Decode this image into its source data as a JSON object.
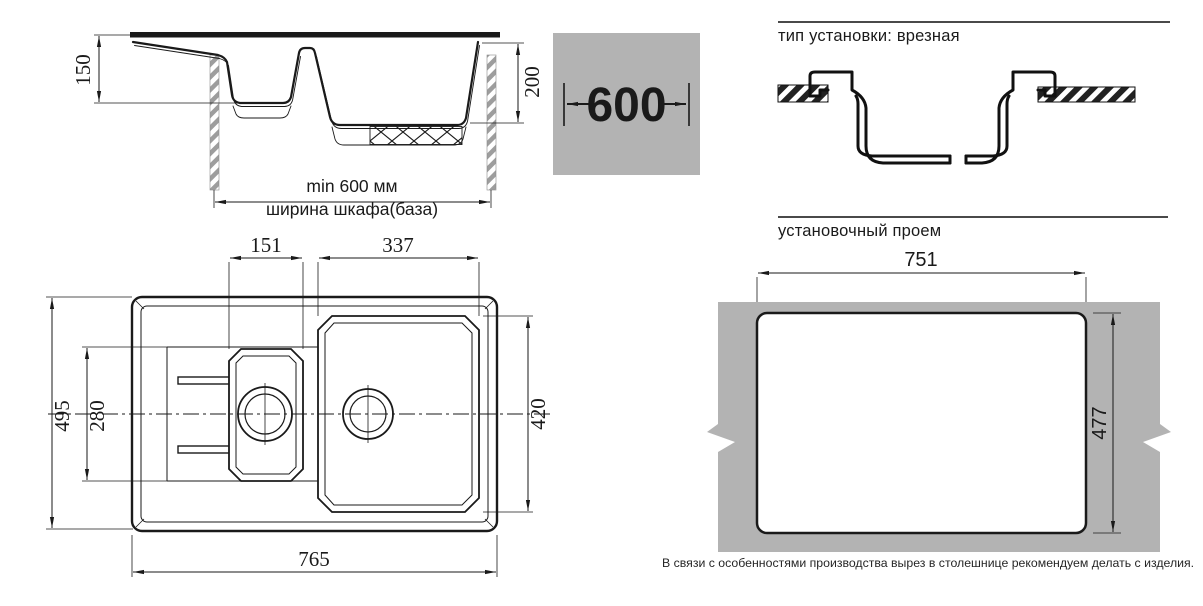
{
  "side_view": {
    "depth_small": "150",
    "depth_large": "200",
    "min_width_label": "min 600 мм",
    "cabinet_label": "ширина шкафа(база)"
  },
  "cabinet_badge": {
    "value": "600"
  },
  "install_type": {
    "title": "тип установки: врезная"
  },
  "opening": {
    "title": "установочный проем",
    "width": "751",
    "height": "477",
    "note": "В связи с особенностями производства вырез в столешнице рекомендуем делать с изделия."
  },
  "top_view": {
    "small_bowl_width": "151",
    "large_bowl_width": "337",
    "overall_depth": "495",
    "small_bowl_depth": "280",
    "large_bowl_depth": "420",
    "overall_width": "765"
  },
  "colors": {
    "line": "#1a1a1a",
    "panel_gray": "#b3b3b3"
  }
}
